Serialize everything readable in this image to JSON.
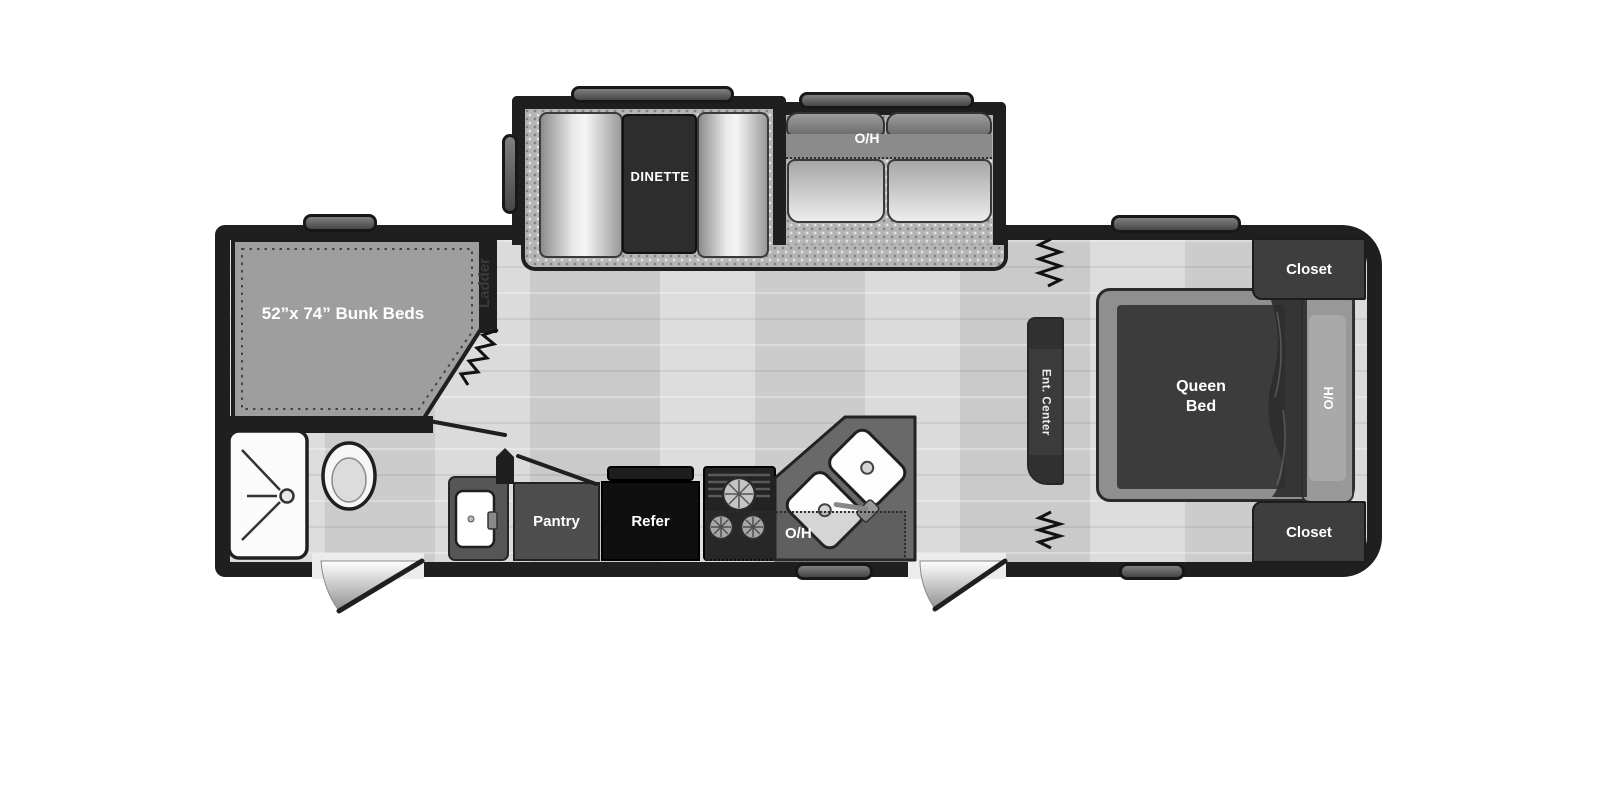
{
  "floorplan": {
    "slide_outs": {
      "dinette_label": "DINETTE",
      "sofa_overhead_label": "O/H"
    },
    "bunk_room": {
      "bunk_label": "52”x 74” Bunk Beds",
      "ladder_label": "Ladder"
    },
    "kitchen": {
      "pantry_label": "Pantry",
      "refrigerator_label": "Refer",
      "overhead_label": "O/H"
    },
    "living_area": {
      "entertainment_center_label": "Ent. Center"
    },
    "bedroom": {
      "bed_label": "Queen Bed",
      "overhead_label": "O/H",
      "closet_top_label": "Closet",
      "closet_bottom_label": "Closet"
    }
  },
  "colors": {
    "background": "#ffffff",
    "wall": "#1f1f1f",
    "wood_floor": "#d7d7d7",
    "slide_carpet": "#b5b5b5",
    "bunk_mat": "#9e9e9e",
    "dark_furniture": "#303030",
    "medium_furniture": "#565656",
    "refrigerator": "#0f0f0f",
    "label_text": "#ffffff"
  }
}
